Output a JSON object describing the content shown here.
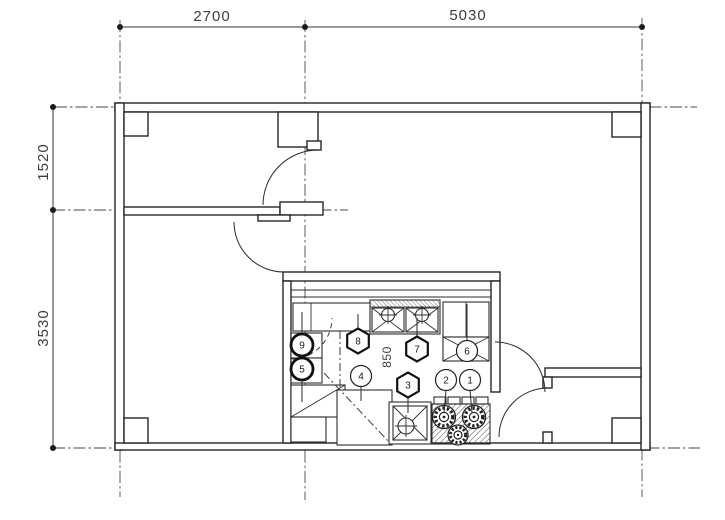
{
  "drawing": {
    "type": "architectural floor plan",
    "colors": {
      "background": "#ffffff",
      "line": "#2b2b2b",
      "dim_text": "#3d3d3d"
    },
    "dimensions": {
      "top": [
        {
          "label": "2700"
        },
        {
          "label": "5030"
        }
      ],
      "left": [
        {
          "label": "1520"
        },
        {
          "label": "3530"
        }
      ],
      "interior": [
        {
          "label": "850"
        }
      ]
    },
    "markers": [
      {
        "label": "1",
        "shape": "circle"
      },
      {
        "label": "2",
        "shape": "circle"
      },
      {
        "label": "3",
        "shape": "hexagon"
      },
      {
        "label": "4",
        "shape": "circle"
      },
      {
        "label": "5",
        "shape": "circle-bold"
      },
      {
        "label": "6",
        "shape": "circle"
      },
      {
        "label": "7",
        "shape": "hexagon"
      },
      {
        "label": "8",
        "shape": "hexagon"
      },
      {
        "label": "9",
        "shape": "circle-bold"
      }
    ]
  }
}
